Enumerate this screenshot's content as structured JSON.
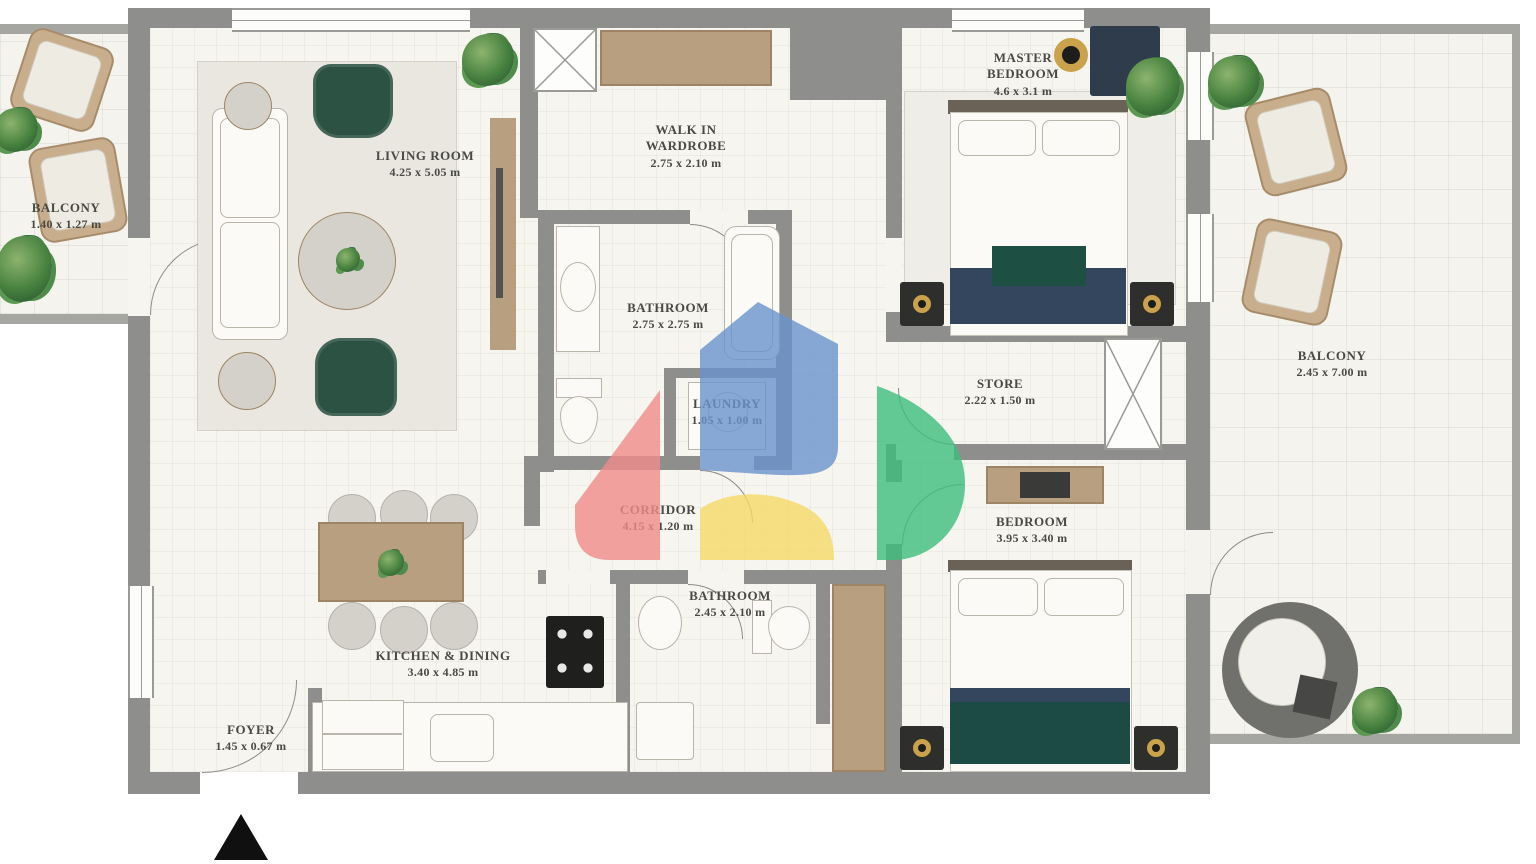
{
  "plan": {
    "title": "2 Bedroom Apartment Floor Plan",
    "rooms": [
      {
        "name": "BALCONY",
        "dims": "1.40 x 1.27 m"
      },
      {
        "name": "LIVING ROOM",
        "dims": "4.25 x 5.05 m"
      },
      {
        "name": "WALK IN WARDROBE",
        "dims": "2.75 x 2.10 m"
      },
      {
        "name": "MASTER BEDROOM",
        "dims": "4.6 x 3.1 m"
      },
      {
        "name": "BATHROOM",
        "dims": "2.75 x 2.75 m"
      },
      {
        "name": "LAUNDRY",
        "dims": "1.05 x 1.00 m"
      },
      {
        "name": "STORE",
        "dims": "2.22 x 1.50 m"
      },
      {
        "name": "CORRIDOR",
        "dims": "4.15 x 1.20 m"
      },
      {
        "name": "BATHROOM",
        "dims": "2.45 x 2.10 m"
      },
      {
        "name": "BEDROOM",
        "dims": "3.95 x 3.40 m"
      },
      {
        "name": "KITCHEN & DINING",
        "dims": "3.40 x 4.85 m"
      },
      {
        "name": "FOYER",
        "dims": "1.45 x 0.67 m"
      },
      {
        "name": "BALCONY",
        "dims": "2.45 x 7.00 m"
      }
    ]
  },
  "watermark": {
    "colors": {
      "red": "#F28B8B",
      "blue": "#6B94CE",
      "yellow": "#F6D967",
      "green": "#3EBE7E"
    }
  },
  "palette": {
    "wall": "#8E8E8C",
    "floor": "#F6F5EF",
    "wood": "#B79F80",
    "sofa_green": "#2C5244",
    "bed_navy": "#33465E",
    "bed_teal": "#1C4A44",
    "lamp_gold": "#C9A24B"
  }
}
